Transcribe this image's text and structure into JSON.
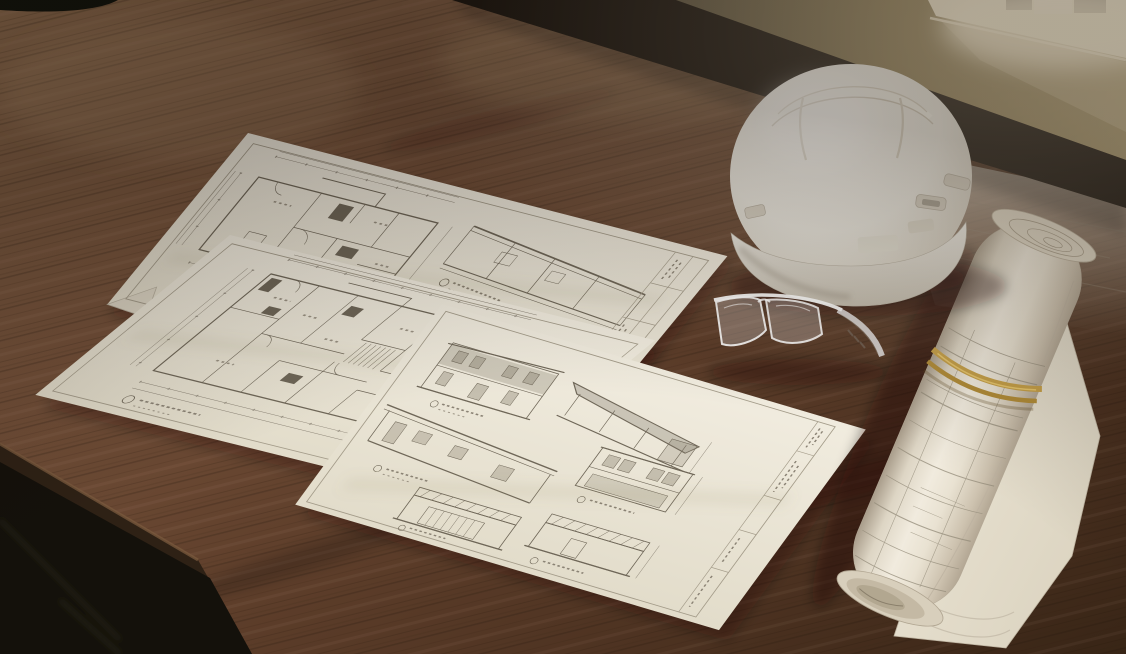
{
  "scene": {
    "type": "photograph",
    "description": "Architectural blueprint sheets spread across a dark walnut wood desk beside a white construction hard hat, clear safety glasses and a rolled set of plans bound with a gold rubber band, lit by warm sunlight from a window at the upper right.",
    "lighting": "warm sunlight from window at upper right",
    "surface": "dark walnut wood desk"
  },
  "objects": {
    "desk": {
      "label": "dark walnut wood desk surface",
      "color": "#5e3f2b"
    },
    "floor": {
      "label": "dark floor beyond front edge of desk",
      "color": "#14110b"
    },
    "wall": {
      "label": "tan wall in shadow behind desk",
      "color": "#96855c"
    },
    "window_sill": {
      "label": "sunlit window sill with white frame",
      "glow_color": "#f8eed6"
    },
    "hard_hat": {
      "label": "white construction hard hat with ribbed crown and side accessory slots",
      "color": "#f2f1ec"
    },
    "safety_glasses": {
      "label": "clear plastic safety glasses",
      "color": "#eef0f3"
    },
    "rolled_plans": {
      "label": "rolled architectural drawings secured with a rubber band",
      "paper_color": "#ece5d6"
    },
    "rubber_band": {
      "label": "gold rubber band around rolled plans",
      "color": "#c39a3f"
    },
    "sheet_top": {
      "label": "drawing sheet with small floor plan, building section and title block"
    },
    "sheet_left": {
      "label": "drawing sheet with large dimensioned floor plan and folded corner"
    },
    "sheet_front": {
      "label": "drawing sheet with exterior elevation drawings and title block"
    }
  },
  "sheets": {
    "count": 3,
    "paper_color": "#ece7d9",
    "line_color": "#8a8274",
    "sheet_top_contents": [
      "floor plan",
      "building section",
      "title block strip"
    ],
    "sheet_left_contents": [
      "large floor plan",
      "stair",
      "dimension strings",
      "circled drawing label"
    ],
    "sheet_front_contents": [
      "two-story elevation",
      "shed-roof elevation",
      "long side elevation",
      "garage front elevation",
      "garage side elevation",
      "title block strip"
    ],
    "labels_note": "drawing titles and scale notes are present on the sheets but too small to be legible"
  },
  "palette": {
    "wood_dark": "#382516",
    "wood_mid": "#64452f",
    "wood_light": "#8f6d4f",
    "wood_sunlit": "#cdc4b6",
    "shadow_band": "#15100b",
    "paper": "#ece7d9",
    "hat_white": "#f6f4ee",
    "hat_shade": "#c6bfb1",
    "band_gold": "#c39a3f",
    "wall_tan": "#96855c",
    "window_glow": "#f8eed6"
  }
}
